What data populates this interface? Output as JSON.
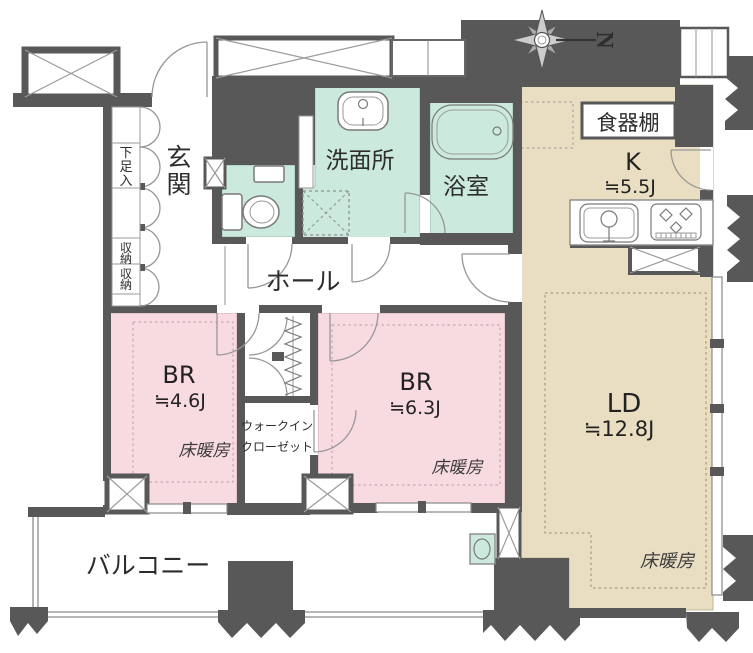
{
  "plan": {
    "type": "apartment-floor-plan",
    "compass": {
      "label": "N"
    },
    "colors": {
      "wall": "#585858",
      "wet_room": "#cbeadd",
      "bedroom": "#f8dbe1",
      "ldk": "#e9dec1",
      "heating_dash_ld": "#9a8c66",
      "heating_dash_br": "#c49aa8"
    },
    "rooms": {
      "genkan": {
        "chars": [
          "玄",
          "関"
        ]
      },
      "shoebox": {
        "chars": [
          "下",
          "足",
          "入"
        ]
      },
      "storage_upper": {
        "chars": [
          "収",
          "納"
        ]
      },
      "storage_lower": {
        "chars": [
          "収",
          "納"
        ]
      },
      "washroom": {
        "label": "洗面所"
      },
      "bathroom": {
        "label": "浴室"
      },
      "hall": {
        "label": "ホール"
      },
      "cupboard": {
        "label": "食器棚"
      },
      "kitchen": {
        "label": "K",
        "size": "≒5.5J"
      },
      "living_dining": {
        "label": "LD",
        "size": "≒12.8J",
        "floor_heating": "床暖房"
      },
      "bedroom1": {
        "label": "BR",
        "size": "≒4.6J",
        "floor_heating": "床暖房"
      },
      "bedroom2": {
        "label": "BR",
        "size": "≒6.3J",
        "floor_heating": "床暖房"
      },
      "walk_in_closet": {
        "label_line1": "ウォークイン",
        "label_line2": "クローゼット"
      },
      "balcony": {
        "label": "バルコニー"
      }
    }
  }
}
